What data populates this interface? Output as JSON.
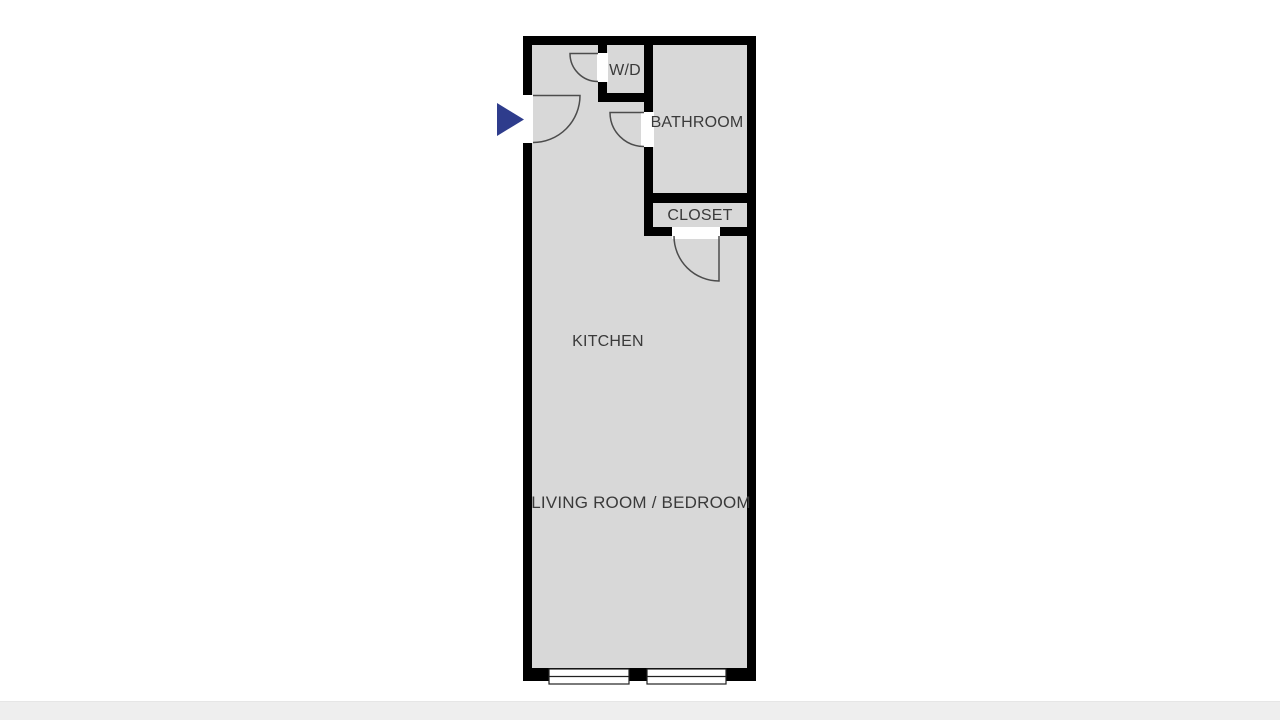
{
  "floorplan": {
    "rooms": [
      {
        "id": "wd",
        "label": "W/D"
      },
      {
        "id": "bathroom",
        "label": "BATHROOM"
      },
      {
        "id": "closet",
        "label": "CLOSET"
      },
      {
        "id": "kitchen",
        "label": "KITCHEN"
      },
      {
        "id": "living_bedroom",
        "label": "LIVING ROOM / BEDROOM"
      }
    ],
    "entry": {
      "icon": "entry-arrow-icon",
      "direction": "right"
    },
    "colors": {
      "wall": "#000000",
      "floor": "#d8d8d8",
      "door_line": "#4c4c4c",
      "label_text": "#3a3a3a",
      "entry_arrow": "#2e3c8c",
      "window_outline": "#222222",
      "footer_bar": "#eeeeee"
    }
  }
}
